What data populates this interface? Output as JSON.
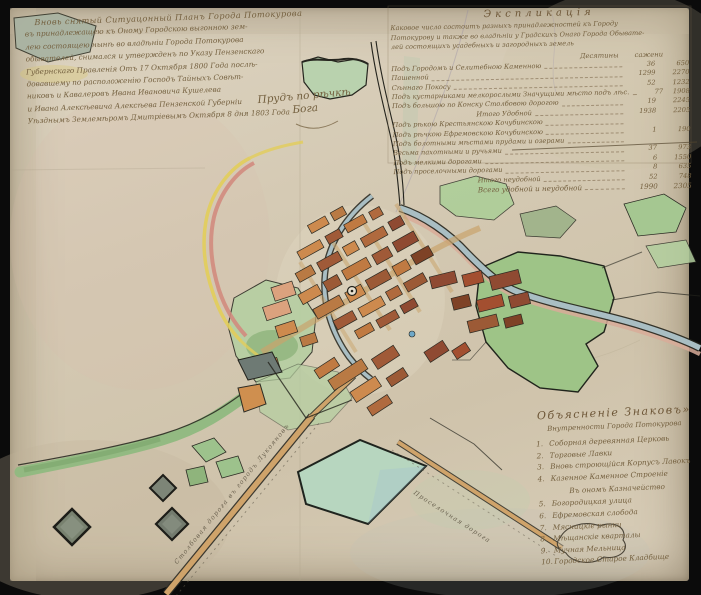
{
  "document": {
    "kind": "hand-drawn town plan, watercolour and ink, dated 1803",
    "language": "Russian, pre-reform orthography"
  },
  "title_block": {
    "lines": [
      "Вновь снятый Ситуацонный Планъ Города Потокурова",
      "въ принадлежащею къ Оному Городскою выгонною зем-",
      "лею состоящею нынѣ во владѣнiи Города Потокурова",
      "обывателей, снимался и утвержденъ по Указу Пензенскаго",
      "Губернскаго Правленiя Отъ 17 Октября 1800 Года послѣ-",
      "довавшему по расположенiю Господъ Тайныхъ Совѣт-",
      "никовъ и Кавалеровъ Ивана Ивановича Кушелева",
      "и Ивана Алексѣевича Алексѣева Пензенской Губернiи",
      "Уѣзднымъ Землемѣромъ Дмитрiевымъ Октября 8 дня 1803 Года"
    ]
  },
  "explication": {
    "header": "Экспликацiя",
    "intro_lines": [
      "Каковое число состоитъ разныхъ принадлежностей къ Городу",
      "Потокурову и также во владѣнiи у Градскихъ Онаго Города Обывате-",
      "лей состоящихъ усадебныхъ и загородныхъ земель"
    ],
    "col_headers": {
      "des": "Десятины",
      "saj": "сажени"
    },
    "rows": [
      {
        "label": "Подъ Городомъ и Селитебною Каменною",
        "d": "36",
        "s": "650"
      },
      {
        "label": "Пашенной",
        "d": "1299",
        "s": "2270"
      },
      {
        "label": "Сѣннаго Покосу",
        "d": "52",
        "s": "1232"
      },
      {
        "label": "Подъ кустарниками мелкорослыми Значущими мѣсто подъ лѣс.",
        "d": "77",
        "s": "1908"
      },
      {
        "label": "Подъ большою по Конску Столбовою дорогою",
        "d": "19",
        "s": "2245"
      },
      {
        "label": "Итого Удобной",
        "d": "1938",
        "s": "2205"
      },
      {
        "label": "Подъ рѣкою Крестьянскою Кочубинскою",
        "d": "",
        "s": ""
      },
      {
        "label": "Подъ рѣчкою Ефремовскою Кочубинскою",
        "d": "1",
        "s": "190"
      },
      {
        "label": "Подъ болотными мѣстами прудами и озерами",
        "d": "",
        "s": ""
      },
      {
        "label": "Весьма пахотными и ручьями",
        "d": "37",
        "s": "973"
      },
      {
        "label": "Подъ мелкими дорогами",
        "d": "6",
        "s": "1550"
      },
      {
        "label": "Подъ проселочными дорогами",
        "d": "8",
        "s": "635"
      },
      {
        "label": "Итого неудобной",
        "d": "52",
        "s": "748"
      },
      {
        "label": "Всего удобной и неудобной",
        "d": "1990",
        "s": "2305"
      }
    ]
  },
  "legend": {
    "header": "Объясненiе Знаковъ»",
    "subheader": "Внутренности Города Потокурова",
    "items": [
      {
        "num": "1.",
        "label": "Соборная деревянная Церковь"
      },
      {
        "num": "2.",
        "label": "Торговые Лавки"
      },
      {
        "num": "3.",
        "label": "Вновь строющiйся Корпусъ Лавокъ"
      },
      {
        "num": "4.",
        "label": "Казенное Каменное Строенiе"
      },
      {
        "num": "5.",
        "label": "Богородицкая улица"
      },
      {
        "num": "6.",
        "label": "Ефремовская слобода"
      },
      {
        "num": "7.",
        "label": "Мясницкiе рынки"
      },
      {
        "num": "8.",
        "label": "Мѣщанскiе кварталы"
      },
      {
        "num": "9.",
        "label": "Мучная Мельница"
      },
      {
        "num": "10.",
        "label": "Городское Старое Кладбище"
      }
    ],
    "section_note": "Въ ономъ Казначейство"
  },
  "map_labels": {
    "pond_line1": "Прудъ по рѣчкѣ",
    "pond_line2": "Бога",
    "road_sw": "Столбовая дорога въ городъ Лукояновъ",
    "road_se": "Проселочная дорога"
  },
  "colors": {
    "frame": "#0b0b0b",
    "paper": "#d5cab4",
    "ink_outline": "#2b2a22",
    "handwriting_ink": "#74603f",
    "water": "#a9bec3",
    "field_green": "#9ec487",
    "meadow_green": "#b6cfa2",
    "building_orange": "#cd8a4e",
    "building_brown": "#9c5a36",
    "building_darkred": "#8f4a32",
    "road_tan": "#cfa36a",
    "boundary_yellow": "#e2cd5a",
    "boundary_pink": "#d28b7e",
    "quarry_gray": "#78816f"
  }
}
